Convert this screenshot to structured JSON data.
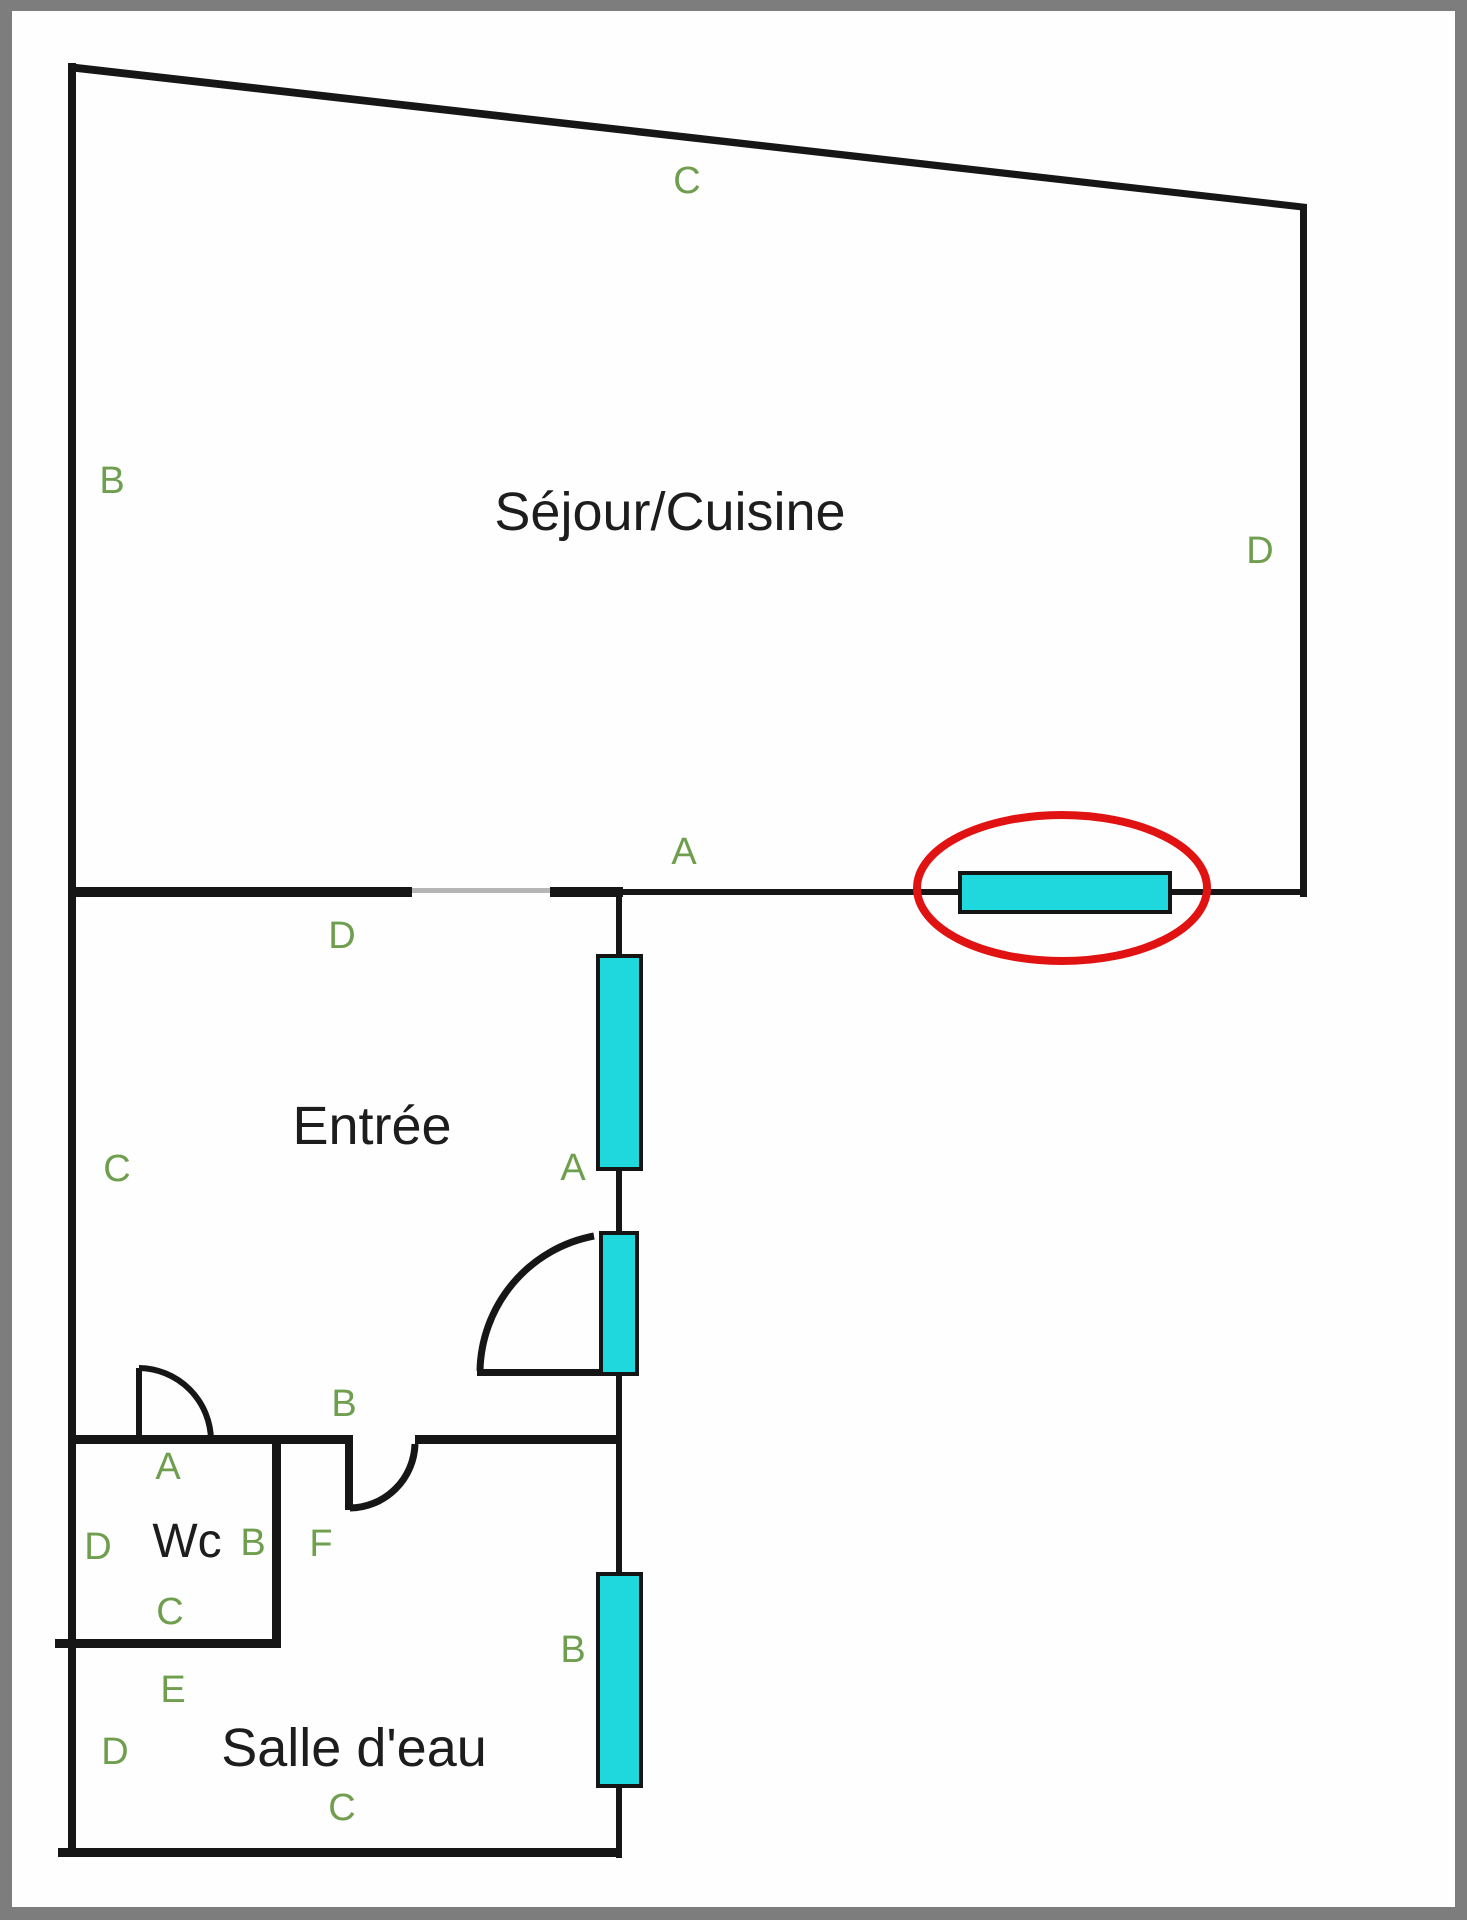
{
  "colors": {
    "frame": "#7d7d7d",
    "paper": "#fefefe",
    "wall": "#161616",
    "opening": "#b5b5b5",
    "window_fill": "#1fd8de",
    "window_border": "#151515",
    "highlight": "#e01212",
    "label": "#6f9e4e",
    "room_text": "#1d1d1d"
  },
  "rooms": [
    {
      "id": "sejour-cuisine",
      "name": "Séjour/Cuisine"
    },
    {
      "id": "entree",
      "name": "Entrée"
    },
    {
      "id": "wc",
      "name": "Wc"
    },
    {
      "id": "salle-deau",
      "name": "Salle d'eau"
    }
  ],
  "wall_labels": [
    {
      "letter": "C",
      "area": "sejour-top-wall"
    },
    {
      "letter": "B",
      "area": "sejour-left-wall"
    },
    {
      "letter": "D",
      "area": "sejour-right-wall"
    },
    {
      "letter": "A",
      "area": "sejour-bottom-wall"
    },
    {
      "letter": "D",
      "area": "entree-top-wall"
    },
    {
      "letter": "C",
      "area": "entree-left-wall"
    },
    {
      "letter": "A",
      "area": "entree-right-wall"
    },
    {
      "letter": "B",
      "area": "entree-bottom-wall"
    },
    {
      "letter": "A",
      "area": "wc-top-wall"
    },
    {
      "letter": "D",
      "area": "wc-left-wall"
    },
    {
      "letter": "B",
      "area": "wc-right-wall"
    },
    {
      "letter": "F",
      "area": "wc-doorway-passage"
    },
    {
      "letter": "C",
      "area": "wc-bottom-wall"
    },
    {
      "letter": "E",
      "area": "salle-deau-top-wall"
    },
    {
      "letter": "D",
      "area": "salle-deau-left-wall"
    },
    {
      "letter": "B",
      "area": "salle-deau-right-wall"
    },
    {
      "letter": "C",
      "area": "salle-deau-bottom-wall"
    }
  ],
  "windows": [
    {
      "id": "window-sejour-highlighted",
      "location": "sejour-bottom-wall",
      "highlighted": true
    },
    {
      "id": "window-entree-upper",
      "location": "entree-right-wall",
      "highlighted": false
    },
    {
      "id": "window-entree-lower",
      "location": "entree-right-wall",
      "highlighted": false
    },
    {
      "id": "window-salle-deau",
      "location": "salle-deau-right-wall",
      "highlighted": false
    }
  ],
  "highlight": {
    "shape": "ellipse",
    "target": "window-sejour-highlighted"
  }
}
